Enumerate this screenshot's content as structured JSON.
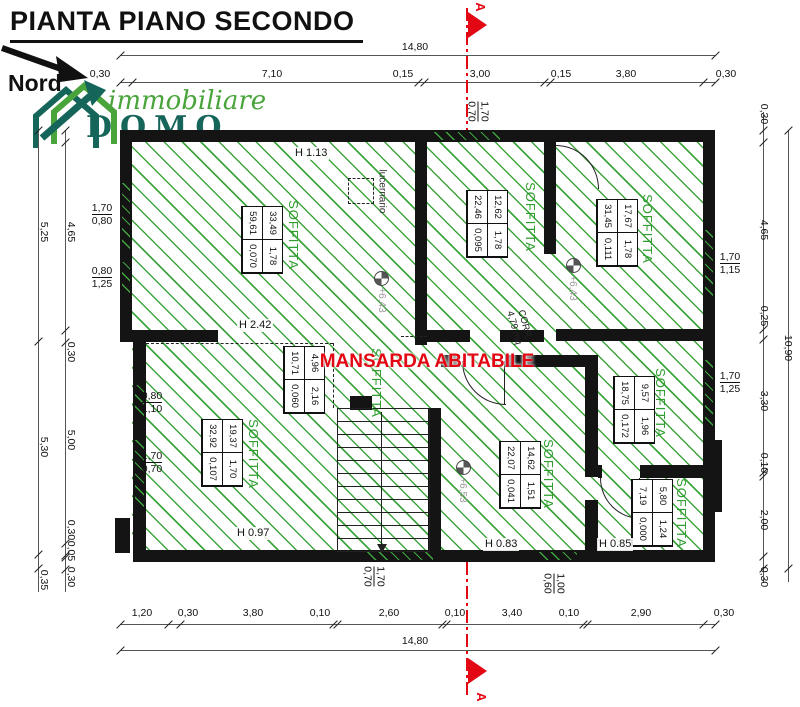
{
  "title": "PIANTA PIANO SECONDO",
  "north": "Nord",
  "logo": {
    "top": "immobiliare",
    "bottom": "DOMO",
    "green": "#4aa43c",
    "dark": "#16655a"
  },
  "section": {
    "label": "A"
  },
  "mansarda": "MANSARDA ABITABILE",
  "corridor": {
    "name": "CORR.",
    "area": "4,79 mq"
  },
  "skylight": "lucernario",
  "levels": [
    "+6,43",
    "+6,43",
    "+6,53"
  ],
  "heights": [
    "H 1.13",
    "H 2.42",
    "H 0.97",
    "H 0.83",
    "H 0.85"
  ],
  "colors": {
    "hatch": "#3fa53f",
    "room_label": "#2f9e2f",
    "accent_red": "#e30613"
  },
  "rooms": [
    {
      "name": "SOFFITTA",
      "table": [
        [
          "33,49",
          "1,78"
        ],
        [
          "59,61",
          "0,070"
        ]
      ]
    },
    {
      "name": "SOFFITTA",
      "table": [
        [
          "12,62",
          "1,78"
        ],
        [
          "22,46",
          "0,095"
        ]
      ]
    },
    {
      "name": "SOFFITTA",
      "table": [
        [
          "17,67",
          "1,78"
        ],
        [
          "31,45",
          "0,111"
        ]
      ]
    },
    {
      "name": "SOFFITTA",
      "table": [
        [
          "4,96",
          "2,16"
        ],
        [
          "10,71",
          "0,060"
        ]
      ]
    },
    {
      "name": "SOFFITTA",
      "table": [
        [
          "9,57",
          "1,96"
        ],
        [
          "18,75",
          "0,172"
        ]
      ]
    },
    {
      "name": "SOFFITTA",
      "table": [
        [
          "19,37",
          "1,70"
        ],
        [
          "32,92",
          "0,107"
        ]
      ]
    },
    {
      "name": "SOFFITTA",
      "table": [
        [
          "14,62",
          "1,51"
        ],
        [
          "22,07",
          "0,041"
        ]
      ]
    },
    {
      "name": "SOFFITTA",
      "table": [
        [
          "5,80",
          "1,24"
        ],
        [
          "7,19",
          "0,000"
        ]
      ]
    }
  ],
  "dims": {
    "top_overall": "14,80",
    "top": [
      "0,30",
      "7,10",
      "0,15",
      "3,00",
      "0,15",
      "3,80",
      "0,30"
    ],
    "bottom": [
      "1,20",
      "0,30",
      "3,80",
      "0,10",
      "2,60",
      "0,10",
      "3,40",
      "0,10",
      "2,90",
      "0,30"
    ],
    "bottom_overall": "14,80",
    "left_outer": [
      "5,25",
      "5,30",
      "0,35"
    ],
    "left_inner": [
      "4,65",
      "0,30",
      "5,00",
      "0,30",
      "0,05",
      "0,30"
    ],
    "right_inner": [
      "0,30",
      "4,65",
      "0,25",
      "3,30",
      "0,10",
      "2,00",
      "0,30"
    ],
    "right_overall": "10,90",
    "windows": {
      "top": [
        "1,70",
        "0,70"
      ],
      "left_upper_1": [
        "1,70",
        "0,80"
      ],
      "left_upper_2": [
        "0,80",
        "1,25"
      ],
      "left_lower_1": [
        "0,80",
        "1,10"
      ],
      "left_lower_2": [
        "1,70",
        "0,70"
      ],
      "right_1": [
        "1,70",
        "1,15"
      ],
      "right_2": [
        "1,70",
        "1,25"
      ],
      "bottom_1": [
        "1,70",
        "0,70"
      ],
      "bottom_2": [
        "1,00",
        "0,60"
      ]
    }
  }
}
